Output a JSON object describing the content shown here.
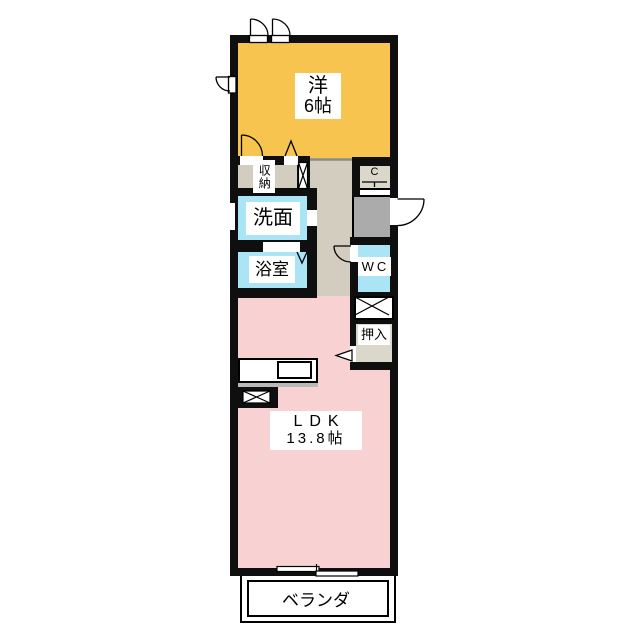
{
  "title": "floor-plan",
  "rooms": {
    "western_room": {
      "line1": "洋",
      "line2": "6帖"
    },
    "storage": "収納",
    "washroom": "洗面",
    "bathroom": "浴室",
    "closet_c": "C",
    "wc": "WC",
    "oshiire": "押入",
    "ldk": {
      "line1": "LDK",
      "line2": "13.8帖"
    },
    "veranda": "ベランダ"
  },
  "colors": {
    "wall": "#0f0f0f",
    "western": "#f6c44f",
    "ldk": "#f8d2d2",
    "water": "#abe4f5",
    "hallway": "#d3cdbf",
    "entrance": "#ababab",
    "closet": "#dcd7cb"
  }
}
